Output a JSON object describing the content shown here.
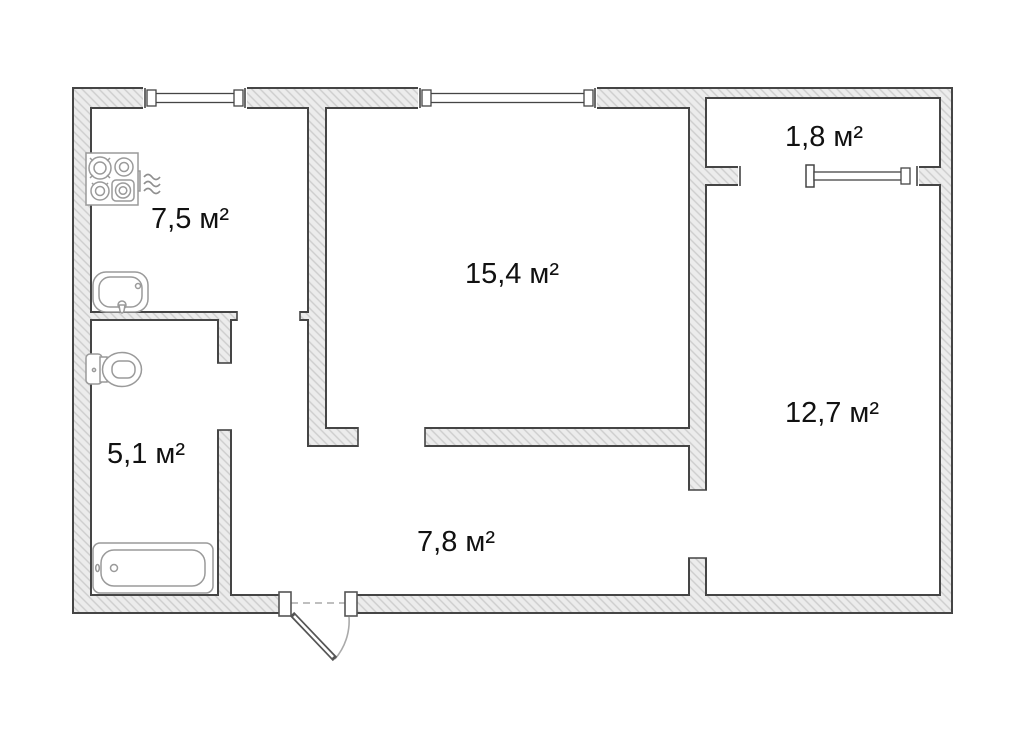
{
  "floor_plan": {
    "type": "apartment-floor-plan",
    "unit": "м²",
    "rooms": {
      "kitchen": {
        "area_label": "7,5 м²",
        "area_value": 7.5
      },
      "living_room": {
        "area_label": "15,4 м²",
        "area_value": 15.4
      },
      "balcony": {
        "area_label": "1,8 м²",
        "area_value": 1.8
      },
      "bedroom": {
        "area_label": "12,7 м²",
        "area_value": 12.7
      },
      "bathroom": {
        "area_label": "5,1 м²",
        "area_value": 5.1
      },
      "hallway": {
        "area_label": "7,8 м²",
        "area_value": 7.8
      }
    },
    "fixtures": [
      {
        "icon": "stove-icon",
        "room": "kitchen"
      },
      {
        "icon": "heat-icon",
        "room": "kitchen"
      },
      {
        "icon": "sink-icon",
        "room": "kitchen"
      },
      {
        "icon": "toilet-icon",
        "room": "bathroom"
      },
      {
        "icon": "bathtub-icon",
        "room": "bathroom"
      }
    ],
    "openings": [
      {
        "icon": "window-icon",
        "location": "kitchen-top-wall"
      },
      {
        "icon": "window-icon",
        "location": "living-room-top-wall"
      },
      {
        "icon": "window-icon",
        "location": "balcony-bedroom-wall"
      },
      {
        "icon": "door-opening",
        "location": "balcony-bedroom-wall"
      },
      {
        "icon": "door-opening",
        "location": "kitchen-hallway"
      },
      {
        "icon": "door-opening",
        "location": "bathroom-hallway"
      },
      {
        "icon": "door-opening",
        "location": "living-room-hallway"
      },
      {
        "icon": "door-opening",
        "location": "hallway-bedroom"
      },
      {
        "icon": "entrance-door-icon",
        "location": "hallway-bottom-wall"
      }
    ],
    "colors": {
      "background": "#ffffff",
      "wall_fill": "#ececec",
      "wall_hatch": "#cdcdcd",
      "wall_outline": "#454545",
      "fixture_stroke": "#9a9a9a",
      "door_swing": "#aaaaaa",
      "text": "#111111"
    }
  }
}
